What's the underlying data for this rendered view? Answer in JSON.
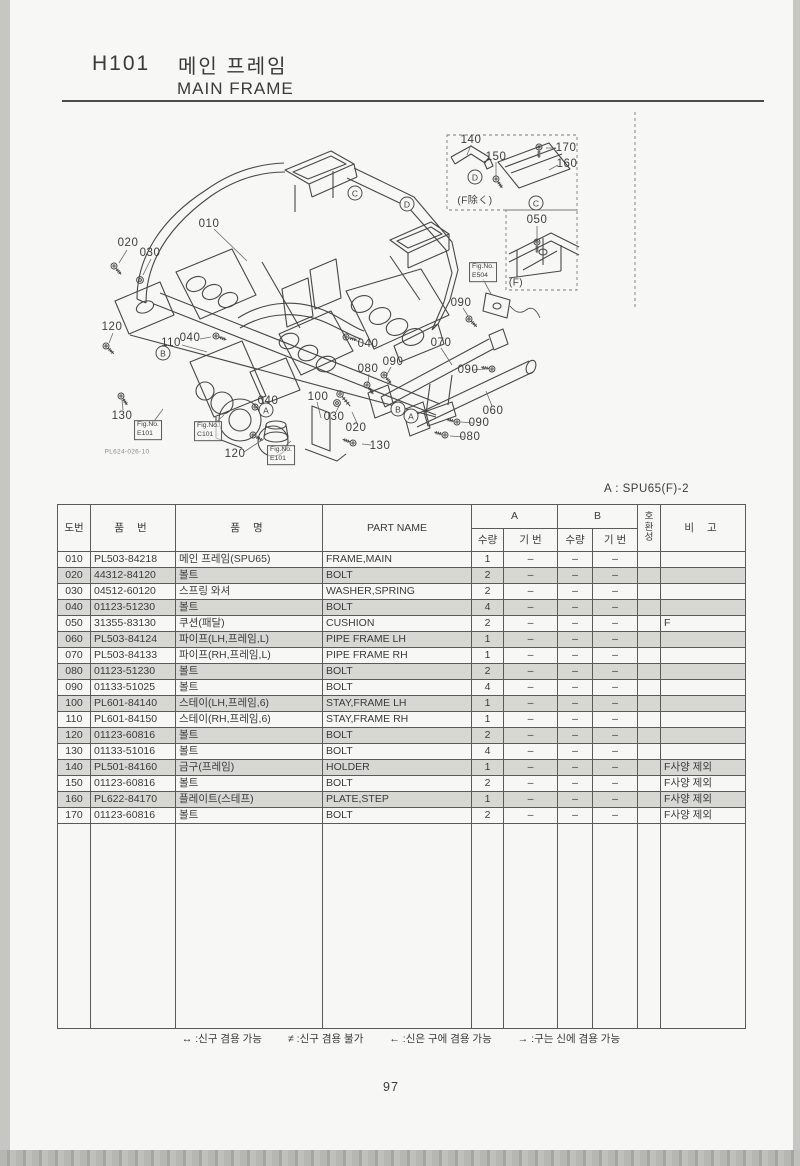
{
  "header": {
    "section_code": "H101",
    "title_ko": "메인 프레임",
    "title_en": "MAIN FRAME"
  },
  "model_note": "A : SPU65(F)-2",
  "page_number": "97",
  "diagram": {
    "drawing_code": "PL624-026-10",
    "callouts": [
      {
        "text": "010",
        "x": 209,
        "y": 224
      },
      {
        "text": "020",
        "x": 128,
        "y": 243
      },
      {
        "text": "030",
        "x": 150,
        "y": 253
      },
      {
        "text": "120",
        "x": 112,
        "y": 327
      },
      {
        "text": "110",
        "x": 171,
        "y": 343
      },
      {
        "text": "040",
        "x": 190,
        "y": 338
      },
      {
        "text": "130",
        "x": 122,
        "y": 416
      },
      {
        "text": "120",
        "x": 235,
        "y": 454
      },
      {
        "text": "100",
        "x": 318,
        "y": 397
      },
      {
        "text": "040",
        "x": 268,
        "y": 401
      },
      {
        "text": "030",
        "x": 334,
        "y": 417
      },
      {
        "text": "020",
        "x": 356,
        "y": 428
      },
      {
        "text": "130",
        "x": 380,
        "y": 446
      },
      {
        "text": "040",
        "x": 368,
        "y": 344
      },
      {
        "text": "080",
        "x": 368,
        "y": 369
      },
      {
        "text": "090",
        "x": 393,
        "y": 362
      },
      {
        "text": "070",
        "x": 441,
        "y": 343
      },
      {
        "text": "090",
        "x": 461,
        "y": 303
      },
      {
        "text": "090",
        "x": 468,
        "y": 370
      },
      {
        "text": "060",
        "x": 493,
        "y": 411
      },
      {
        "text": "090",
        "x": 479,
        "y": 423
      },
      {
        "text": "080",
        "x": 470,
        "y": 437
      },
      {
        "text": "140",
        "x": 471,
        "y": 140
      },
      {
        "text": "150",
        "x": 496,
        "y": 157
      },
      {
        "text": "170",
        "x": 566,
        "y": 148
      },
      {
        "text": "160",
        "x": 567,
        "y": 164
      },
      {
        "text": "050",
        "x": 537,
        "y": 220
      }
    ],
    "circled_letters": [
      {
        "text": "D",
        "x": 475,
        "y": 177
      },
      {
        "text": "C",
        "x": 355,
        "y": 193
      },
      {
        "text": "D",
        "x": 407,
        "y": 204
      },
      {
        "text": "C",
        "x": 536,
        "y": 203
      },
      {
        "text": "B",
        "x": 163,
        "y": 353
      },
      {
        "text": "A",
        "x": 266,
        "y": 410
      },
      {
        "text": "B",
        "x": 398,
        "y": 409
      },
      {
        "text": "A",
        "x": 411,
        "y": 416
      }
    ],
    "notes": [
      {
        "text": "(F除く)",
        "x": 475,
        "y": 199
      },
      {
        "text": "(F)",
        "x": 516,
        "y": 283
      }
    ],
    "fig_refs": [
      {
        "line1": "Fig.No.",
        "line2": "E101",
        "x": 148,
        "y": 430
      },
      {
        "line1": "Fig.No.",
        "line2": "C101",
        "x": 208,
        "y": 431
      },
      {
        "line1": "Fig.No.",
        "line2": "E101",
        "x": 281,
        "y": 455
      },
      {
        "line1": "Fig.No.",
        "line2": "E504",
        "x": 483,
        "y": 272
      }
    ]
  },
  "table": {
    "headers": {
      "col_no": "도번",
      "col_part_no": "품 번",
      "col_name_ko": "품 명",
      "col_part_name": "PART NAME",
      "col_a": "A",
      "col_b": "B",
      "col_qty": "수량",
      "col_serial": "기 번",
      "col_compat_1": "호",
      "col_compat_2": "환",
      "col_compat_3": "성",
      "col_remarks": "비 고"
    },
    "rows": [
      {
        "no": "010",
        "part_no": "PL503-84218",
        "name_ko": "메인 프레임(SPU65)",
        "part_name": "FRAME,MAIN",
        "a_qty": "1",
        "a_serial": "–",
        "b_qty": "–",
        "b_serial": "–",
        "compat": "",
        "remarks": "",
        "shaded": false
      },
      {
        "no": "020",
        "part_no": "44312-84120",
        "name_ko": "볼트",
        "part_name": "BOLT",
        "a_qty": "2",
        "a_serial": "–",
        "b_qty": "–",
        "b_serial": "–",
        "compat": "",
        "remarks": "",
        "shaded": true
      },
      {
        "no": "030",
        "part_no": "04512-60120",
        "name_ko": "스프링 와셔",
        "part_name": "WASHER,SPRING",
        "a_qty": "2",
        "a_serial": "–",
        "b_qty": "–",
        "b_serial": "–",
        "compat": "",
        "remarks": "",
        "shaded": false
      },
      {
        "no": "040",
        "part_no": "01123-51230",
        "name_ko": "볼트",
        "part_name": "BOLT",
        "a_qty": "4",
        "a_serial": "–",
        "b_qty": "–",
        "b_serial": "–",
        "compat": "",
        "remarks": "",
        "shaded": true
      },
      {
        "no": "050",
        "part_no": "31355-83130",
        "name_ko": "쿠션(패달)",
        "part_name": "CUSHION",
        "a_qty": "2",
        "a_serial": "–",
        "b_qty": "–",
        "b_serial": "–",
        "compat": "",
        "remarks": "F",
        "shaded": false
      },
      {
        "no": "060",
        "part_no": "PL503-84124",
        "name_ko": "파이프(LH,프레임,L)",
        "part_name": "PIPE FRAME LH",
        "a_qty": "1",
        "a_serial": "–",
        "b_qty": "–",
        "b_serial": "–",
        "compat": "",
        "remarks": "",
        "shaded": true
      },
      {
        "no": "070",
        "part_no": "PL503-84133",
        "name_ko": "파이프(RH,프레임,L)",
        "part_name": "PIPE FRAME RH",
        "a_qty": "1",
        "a_serial": "–",
        "b_qty": "–",
        "b_serial": "–",
        "compat": "",
        "remarks": "",
        "shaded": false
      },
      {
        "no": "080",
        "part_no": "01123-51230",
        "name_ko": "볼트",
        "part_name": "BOLT",
        "a_qty": "2",
        "a_serial": "–",
        "b_qty": "–",
        "b_serial": "–",
        "compat": "",
        "remarks": "",
        "shaded": true
      },
      {
        "no": "090",
        "part_no": "01133-51025",
        "name_ko": "볼트",
        "part_name": "BOLT",
        "a_qty": "4",
        "a_serial": "–",
        "b_qty": "–",
        "b_serial": "–",
        "compat": "",
        "remarks": "",
        "shaded": false
      },
      {
        "no": "100",
        "part_no": "PL601-84140",
        "name_ko": "스테이(LH,프레임,6)",
        "part_name": "STAY,FRAME LH",
        "a_qty": "1",
        "a_serial": "–",
        "b_qty": "–",
        "b_serial": "–",
        "compat": "",
        "remarks": "",
        "shaded": true
      },
      {
        "no": "110",
        "part_no": "PL601-84150",
        "name_ko": "스테이(RH,프레임,6)",
        "part_name": "STAY,FRAME RH",
        "a_qty": "1",
        "a_serial": "–",
        "b_qty": "–",
        "b_serial": "–",
        "compat": "",
        "remarks": "",
        "shaded": false
      },
      {
        "no": "120",
        "part_no": "01123-60816",
        "name_ko": "볼트",
        "part_name": "BOLT",
        "a_qty": "2",
        "a_serial": "–",
        "b_qty": "–",
        "b_serial": "–",
        "compat": "",
        "remarks": "",
        "shaded": true
      },
      {
        "no": "130",
        "part_no": "01133-51016",
        "name_ko": "볼트",
        "part_name": "BOLT",
        "a_qty": "4",
        "a_serial": "–",
        "b_qty": "–",
        "b_serial": "–",
        "compat": "",
        "remarks": "",
        "shaded": false
      },
      {
        "no": "140",
        "part_no": "PL501-84160",
        "name_ko": "금구(프레임)",
        "part_name": "HOLDER",
        "a_qty": "1",
        "a_serial": "–",
        "b_qty": "–",
        "b_serial": "–",
        "compat": "",
        "remarks": "F사양 제외",
        "shaded": true
      },
      {
        "no": "150",
        "part_no": "01123-60816",
        "name_ko": "볼트",
        "part_name": "BOLT",
        "a_qty": "2",
        "a_serial": "–",
        "b_qty": "–",
        "b_serial": "–",
        "compat": "",
        "remarks": "F사양 제외",
        "shaded": false
      },
      {
        "no": "160",
        "part_no": "PL622-84170",
        "name_ko": "플레이트(스테프)",
        "part_name": "PLATE,STEP",
        "a_qty": "1",
        "a_serial": "–",
        "b_qty": "–",
        "b_serial": "–",
        "compat": "",
        "remarks": "F사양 제외",
        "shaded": true
      },
      {
        "no": "170",
        "part_no": "01123-60816",
        "name_ko": "볼트",
        "part_name": "BOLT",
        "a_qty": "2",
        "a_serial": "–",
        "b_qty": "–",
        "b_serial": "–",
        "compat": "",
        "remarks": "F사양 제외",
        "shaded": false
      }
    ]
  },
  "legend": {
    "items": [
      "↔ :신구 겸용 가능",
      "≠ :신구 겸용 불가",
      "← :신은 구에 겸용 가능",
      "→ :구는 신에 겸용 가능"
    ]
  }
}
